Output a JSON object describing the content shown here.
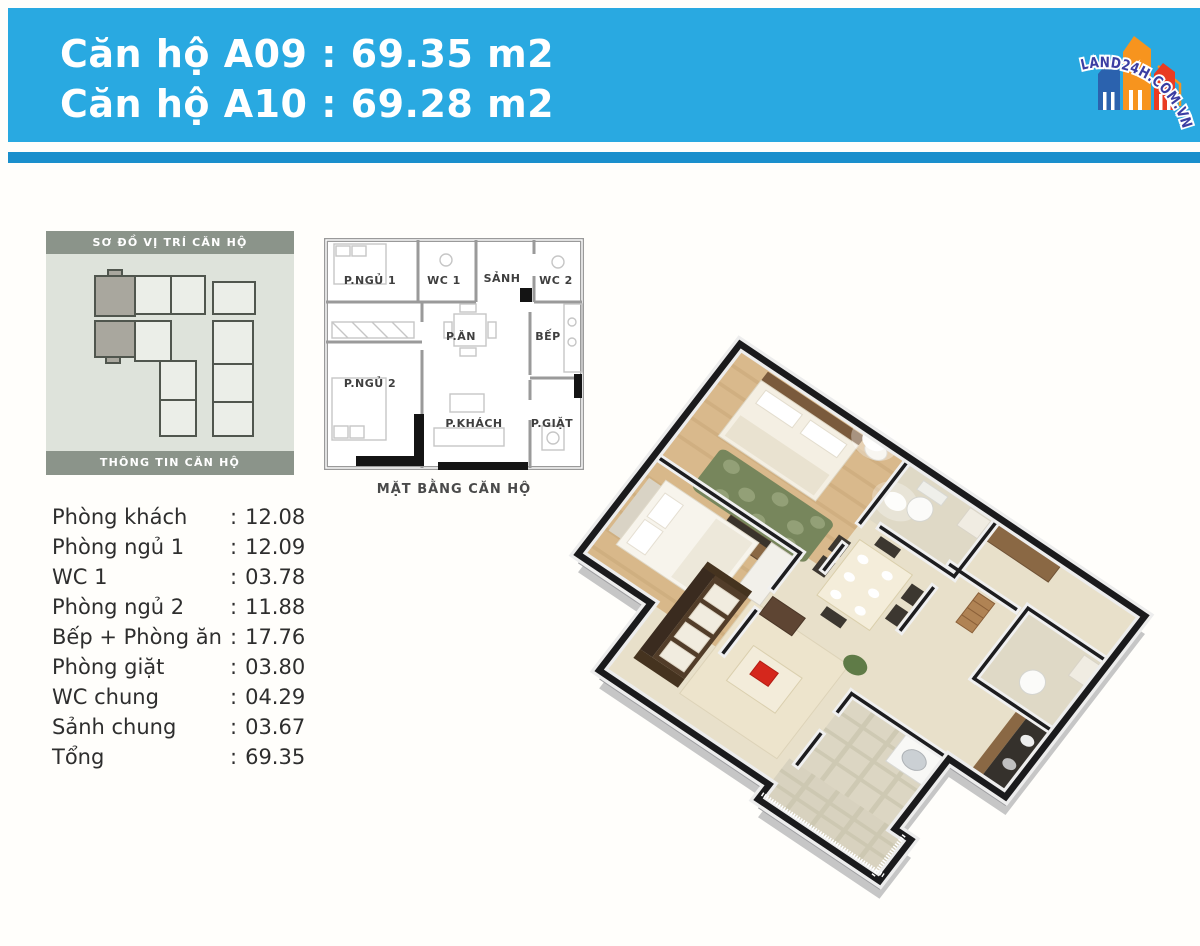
{
  "header": {
    "title_line1": "Căn hộ A09 : 69.35 m2",
    "title_line2": "Căn hộ A10 : 69.28 m2",
    "band_color": "#29A9E1",
    "underline_color": "#1A8FCC",
    "text_color": "#FFFFFF"
  },
  "logo": {
    "text": "LAND24H.COM.VN",
    "text_color": "#3B3EA3",
    "building_blue": "#2B62AE",
    "building_orange": "#F7941E",
    "building_red": "#E93B22"
  },
  "location_panel": {
    "title_top": "SƠ ĐỒ VỊ TRÍ CĂN HỘ",
    "title_bottom": "THÔNG TIN CĂN HỘ",
    "bar_color": "#8B948A",
    "panel_bg": "#DEE3DB",
    "unit_fill": "#EBEEE8",
    "unit_highlight": "#A9A79E"
  },
  "floorplan_2d": {
    "caption": "MẶT BẰNG CĂN HỘ",
    "rooms": [
      "P.NGỦ 1",
      "WC 1",
      "SẢNH",
      "WC 2",
      "P.ĂN",
      "BẾP",
      "P.NGỦ 2",
      "P.KHÁCH",
      "P.GIẶT"
    ]
  },
  "area_table": {
    "separator": ":",
    "rows": [
      {
        "label": "Phòng khách",
        "value": "12.08"
      },
      {
        "label": "Phòng ngủ 1",
        "value": "12.09"
      },
      {
        "label": "WC 1",
        "value": "03.78"
      },
      {
        "label": "Phòng ngủ 2",
        "value": "11.88"
      },
      {
        "label": "Bếp + Phòng ăn",
        "value": "17.76"
      },
      {
        "label": "Phòng giặt",
        "value": "03.80"
      },
      {
        "label": "WC chung",
        "value": "04.29"
      },
      {
        "label": "Sảnh chung",
        "value": "03.67"
      },
      {
        "label": "Tổng",
        "value": "69.35"
      }
    ]
  }
}
